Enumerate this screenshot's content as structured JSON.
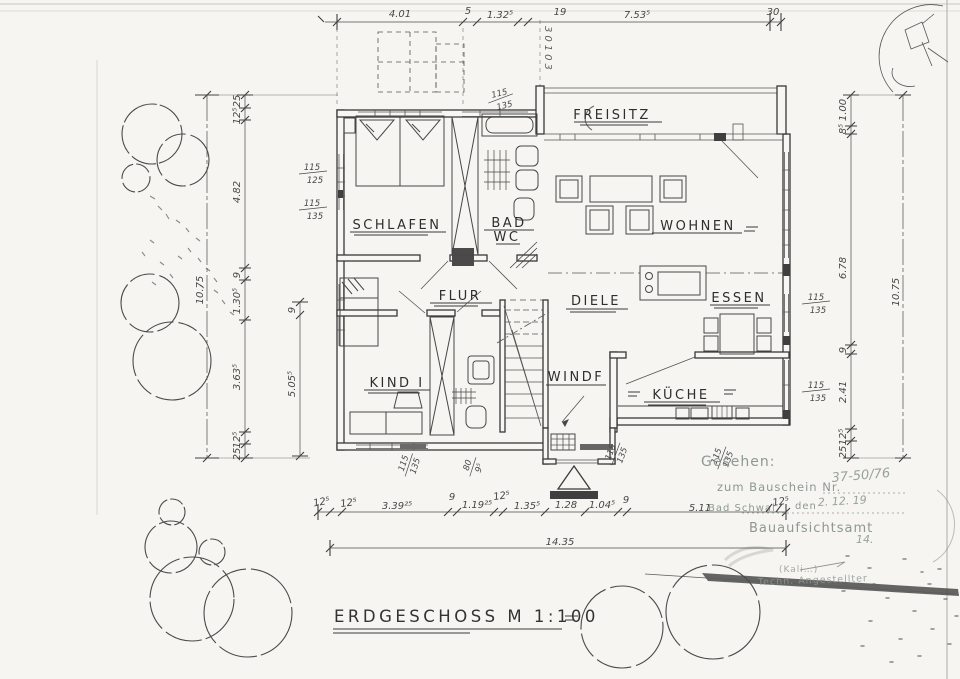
{
  "title": {
    "text": "ERDGESCHOSS M 1:100"
  },
  "colors": {
    "paper": "#f6f5f1",
    "ink": "#3a3a3a",
    "pencil": "#4a4a4a",
    "stamp_ink": "#8e9892"
  },
  "rooms": {
    "freisitz": "FREISITZ",
    "schlafen": "SCHLAFEN",
    "bad": "BAD",
    "wc": "WC",
    "wohnen": "WOHNEN",
    "flur": "FLUR",
    "diele": "DIELE",
    "essen": "ESSEN",
    "kind": "KIND I",
    "windfang": "WINDF",
    "kueche": "KÜCHE"
  },
  "dims": {
    "top": [
      "4.01",
      "5",
      "1.32⁵",
      "19",
      "7.53⁵",
      "30"
    ],
    "left_overall": "10.75",
    "left": [
      "25",
      "12⁵",
      "4.82",
      "9",
      "1.30⁵",
      "3.63⁵",
      "12⁵",
      "25"
    ],
    "left_inner2": [
      "9",
      "5.05⁵"
    ],
    "right": [
      "1.00",
      "8⁵",
      "6.78",
      "9",
      "2.41",
      "12⁵",
      "25"
    ],
    "right_overall": "10.75",
    "bottom": [
      "12⁵",
      "12⁵",
      "3.39²⁵",
      "9",
      "1.19²⁵",
      "12⁵",
      "1.35⁵",
      "1.28",
      "1.04⁵",
      "9",
      "5.11"
    ],
    "bottom_overall": "14.35",
    "overlay": "12⁵",
    "vertical_note": "30103",
    "windows": [
      {
        "n": "115",
        "d": "125"
      },
      {
        "n": "115",
        "d": "135"
      },
      {
        "n": "115",
        "d": "135"
      },
      {
        "n": "115",
        "d": "135"
      },
      {
        "n": "115",
        "d": "135"
      },
      {
        "n": "115",
        "d": "135"
      },
      {
        "n": "80",
        "d": "9⁵"
      },
      {
        "n": "115",
        "d": "135"
      },
      {
        "n": "115",
        "d": "135"
      }
    ]
  },
  "stamp": {
    "gesehen": "Gesehen:",
    "bauschein": "zum Bauschein Nr.",
    "number": "37-50/76",
    "ort": "Bad Schwal",
    "den": "den",
    "date": "2. 12. 19",
    "amt": "Bauaufsichtsamt",
    "note": "14.",
    "sig1": "(Kali…)",
    "sig2": "Techn. Angestellter"
  }
}
